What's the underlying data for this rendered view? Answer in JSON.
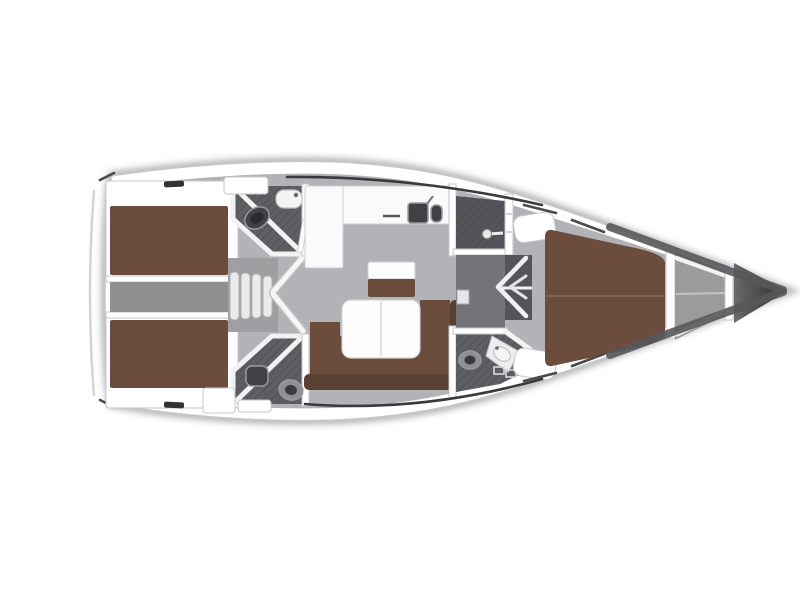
{
  "figure": {
    "title": "Sailing yacht interior layout plan — top view, bow pointing right",
    "type": "floor-plan"
  },
  "palette": {
    "hull_white": "#ffffff",
    "hull_shadow": "#b7b7b9",
    "floor_gray": "#b2b3b6",
    "alcove_gray": "#9e9fa1",
    "corridor_gray": "#8f9092",
    "heads_floor": "#5e5f63",
    "shower_floor": "#54555a",
    "wardrobe_floor": "#737478",
    "forepeak_gray": "#9a9b9d",
    "upholstery_brown": "#6b4c3d",
    "upholstery_brown_dark": "#5a4033",
    "table_white": "#fdfdfd",
    "counter_white": "#fafafa",
    "fixture_dark": "#404145",
    "bow_dark": "#39393b",
    "bow_mid": "#6a6a6d"
  }
}
